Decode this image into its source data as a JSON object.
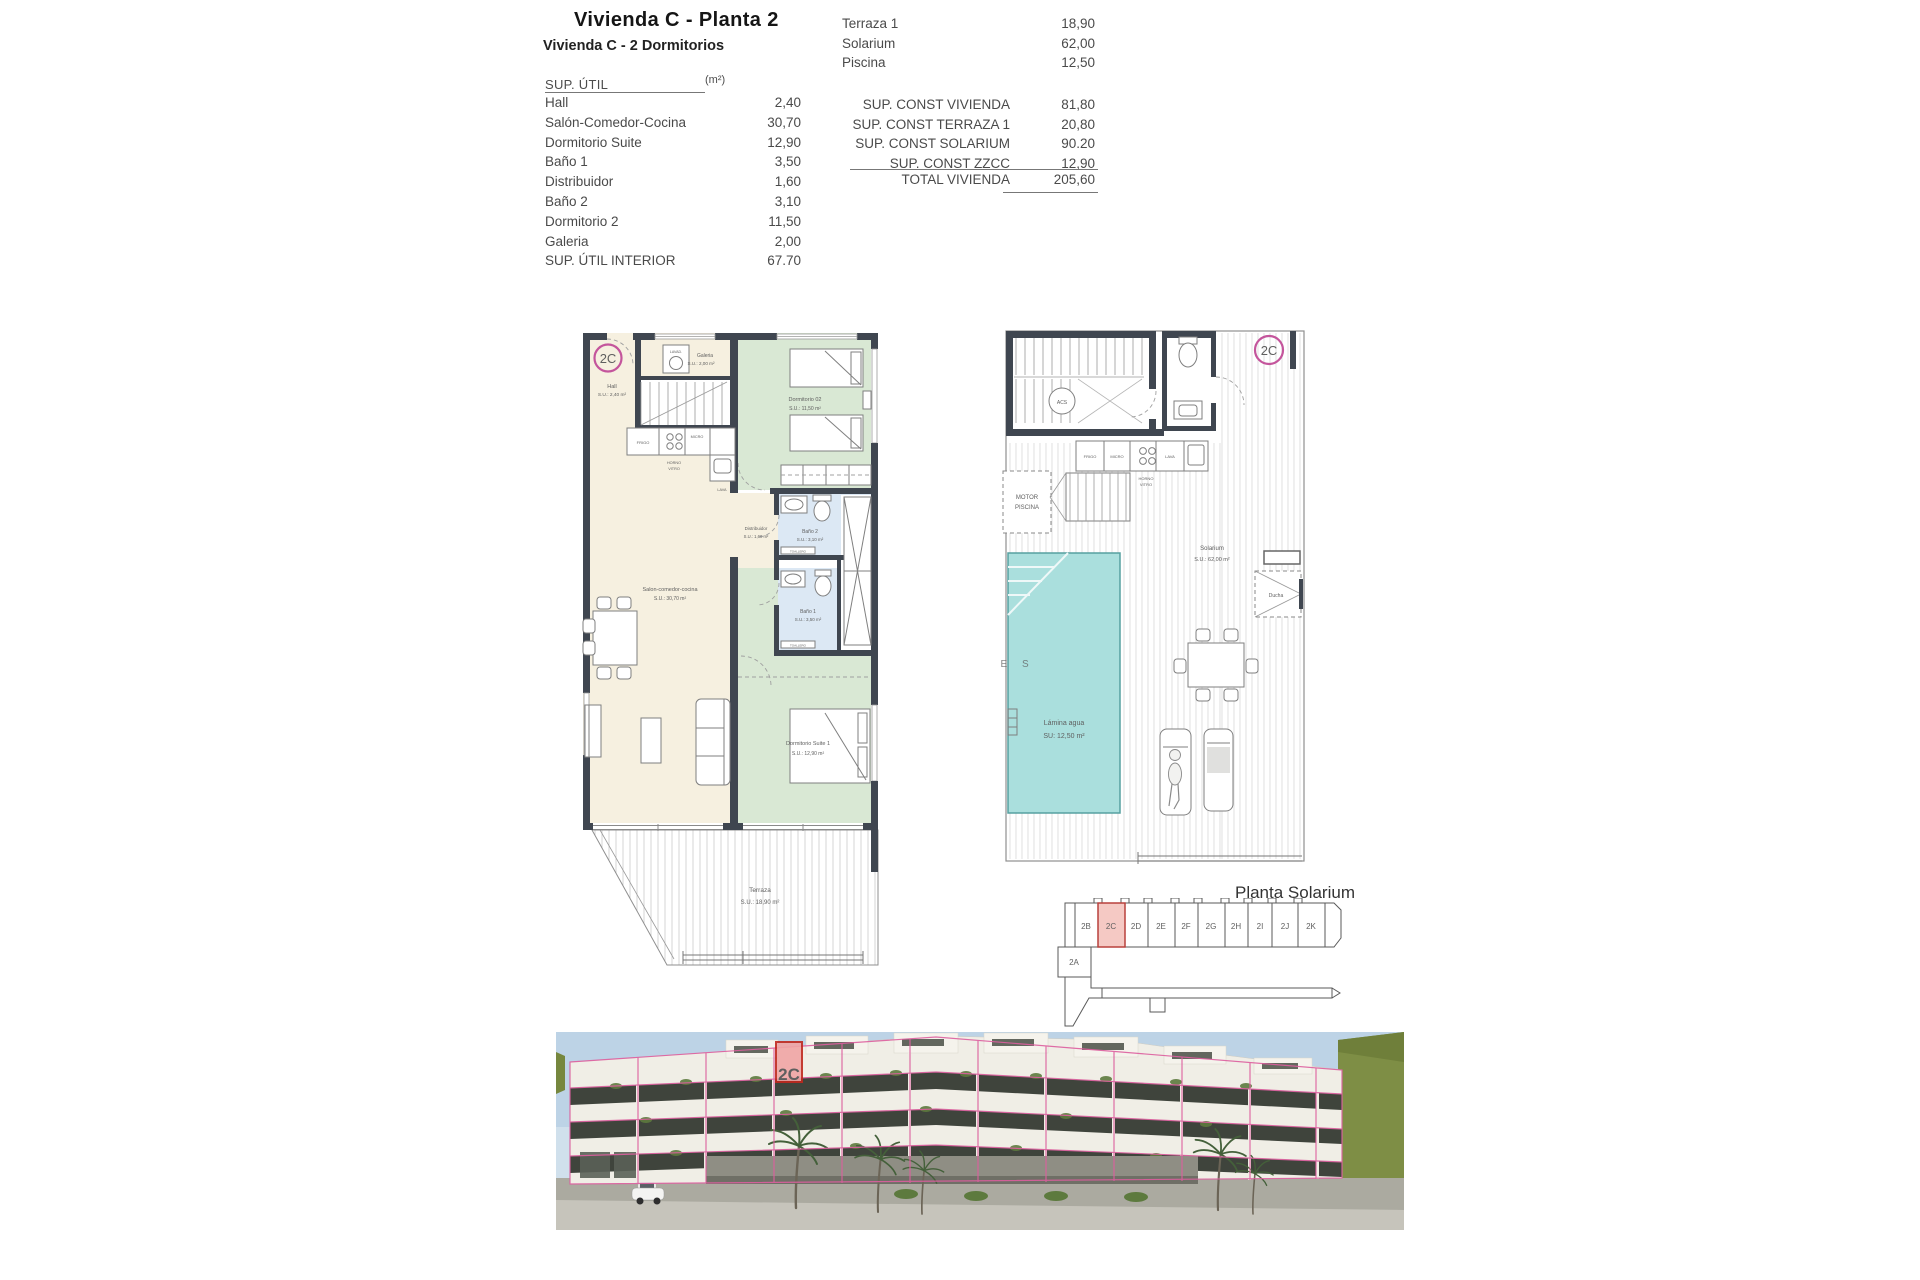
{
  "header": {
    "title": "Vivienda C - Planta 2",
    "subtitle": "Vivienda C - 2 Dormitorios"
  },
  "sup_util_table": {
    "header_label": "SUP. ÚTIL",
    "header_unit": "(m²)",
    "rows": [
      {
        "label": "Hall",
        "value": "2,40"
      },
      {
        "label": "Salón-Comedor-Cocina",
        "value": "30,70"
      },
      {
        "label": "Dormitorio Suite",
        "value": "12,90"
      },
      {
        "label": "Baño 1",
        "value": "3,50"
      },
      {
        "label": "Distribuidor",
        "value": "1,60"
      },
      {
        "label": "Baño 2",
        "value": "3,10"
      },
      {
        "label": "Dormitorio 2",
        "value": "11,50"
      },
      {
        "label": "Galeria",
        "value": "2,00"
      },
      {
        "label": "SUP. ÚTIL INTERIOR",
        "value": "67.70"
      }
    ]
  },
  "exterior_table": {
    "rows": [
      {
        "label": "Terraza 1",
        "value": "18,90"
      },
      {
        "label": "Solarium",
        "value": "62,00"
      },
      {
        "label": "Piscina",
        "value": "12,50"
      }
    ]
  },
  "const_table": {
    "rows": [
      {
        "label": "SUP. CONST VIVIENDA",
        "value": "81,80"
      },
      {
        "label": "SUP. CONST TERRAZA 1",
        "value": "20,80"
      },
      {
        "label": "SUP. CONST SOLARIUM",
        "value": "90.20"
      },
      {
        "label": "SUP. CONST ZZCC",
        "value": "12,90"
      }
    ],
    "total_label": "TOTAL VIVIENDA",
    "total_value": "205,60"
  },
  "floor_plan": {
    "badge": "2C",
    "hall": {
      "name": "Hall",
      "size": "S.U.: 2,40 m²"
    },
    "galeria": {
      "name": "Galeria",
      "size": "S.U.: 2,00 m²",
      "appliance": "LAVAD."
    },
    "dorm2": {
      "name": "Dormitorio 02",
      "size": "S.U.: 11,50 m²"
    },
    "salon": {
      "name": "Salon-comedor-cocina",
      "size": "S.U.: 30,70 m²"
    },
    "distribuidor": {
      "name": "Distribuidor",
      "size": "S.U.: 1,60 m²"
    },
    "bano2": {
      "name": "Baño 2",
      "size": "S.U.: 3,10 m²"
    },
    "bano1": {
      "name": "Baño 1",
      "size": "S.U.: 3,50 m²"
    },
    "suite": {
      "name": "Dormitorio Suite 1",
      "size": "S.U.: 12,90 m²"
    },
    "terraza": {
      "name": "Terraza",
      "size": "S.U.: 18,90 m²"
    },
    "kitchen": {
      "frigo": "FRIGO",
      "micro": "MICRO",
      "horno": "HORNO",
      "vitro": "VITRO",
      "lava": "LAVA"
    },
    "toallero": "TOALLERO"
  },
  "solarium_plan": {
    "badge": "2C",
    "acs": "ACS",
    "motor1": "MOTOR",
    "motor2": "PISCINA",
    "solarium": {
      "name": "Solarium",
      "size": "S.U.: 62,00 m²"
    },
    "ducha": "Ducha",
    "pool": {
      "line1": "Lámina agua",
      "line2": "SU:  12,50 m²"
    },
    "kitchen": {
      "frigo": "FRIGO",
      "micro": "MICRO",
      "horno": "HORNO",
      "vitro": "VITRO",
      "lava": "LAVA"
    },
    "watermark": "M E S"
  },
  "key_plan": {
    "caption": "Planta Solarium",
    "units": [
      "2B",
      "2C",
      "2D",
      "2E",
      "2F",
      "2G",
      "2H",
      "2I",
      "2J",
      "2K"
    ],
    "unit_a": "2A",
    "highlighted_unit": "2C"
  },
  "photo": {
    "marker": "2C"
  },
  "colors": {
    "badge_pink": "#c4559c",
    "wall_dark": "#3f4650",
    "room_cream": "#f6f0e0",
    "room_green": "#d9e8d4",
    "room_blue": "#dce8f4",
    "pool_teal": "#aadfdd",
    "key_highlight": "#f5c9c4",
    "key_highlight_border": "#b8413d",
    "photo_outline": "#dd5f9f",
    "marker_red": "#c0281e"
  }
}
